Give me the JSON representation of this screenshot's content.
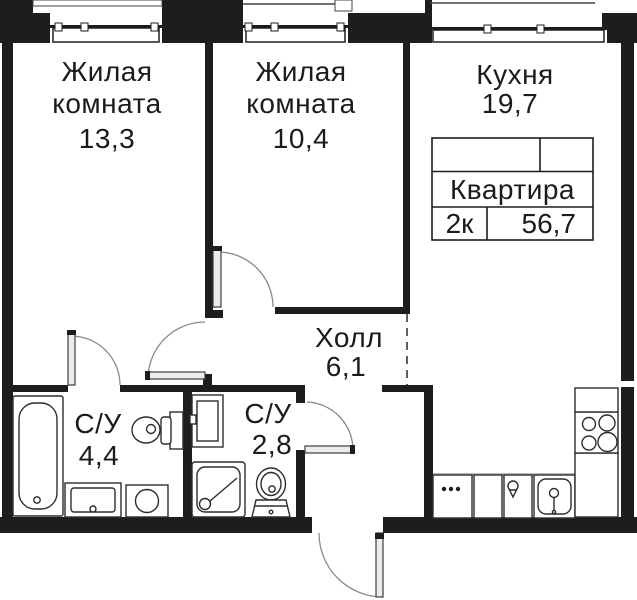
{
  "plan_title": "Floor plan 2k apartment",
  "rooms": [
    {
      "name": "Жилая комната",
      "area": "13,3"
    },
    {
      "name": "Жилая комната",
      "area": "10,4"
    },
    {
      "name": "Кухня",
      "area": "19,7"
    },
    {
      "name": "Холл",
      "area": "6,1"
    },
    {
      "name": "С/У",
      "area": "4,4"
    },
    {
      "name": "С/У",
      "area": "2,8"
    }
  ],
  "info_table": {
    "title": "Квартира",
    "type": "2к",
    "total_area": "56,7"
  },
  "colors": {
    "wall": "#1d1d1d",
    "outline": "#2d2d2d",
    "arc": "#8a8a8a",
    "shade": "#bbbbbb"
  }
}
